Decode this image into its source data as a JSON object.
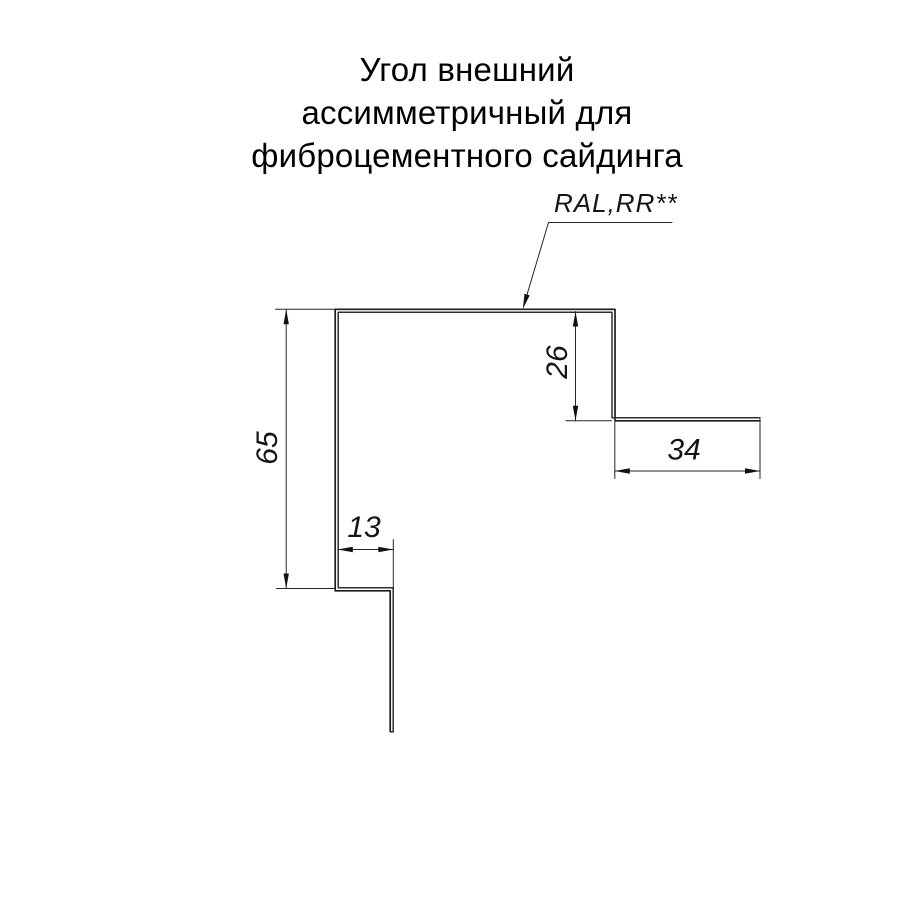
{
  "title": {
    "lines": [
      "Угол внешний",
      "ассимметричный для",
      "фиброцементного сайдинга"
    ]
  },
  "callout": {
    "label": "RAL,RR**"
  },
  "dimensions": {
    "left_height": "65",
    "right_drop": "26",
    "bottom_lip": "13",
    "right_shelf": "34"
  },
  "colors": {
    "background": "#ffffff",
    "line": "#1c1c1c",
    "text": "#000000"
  }
}
